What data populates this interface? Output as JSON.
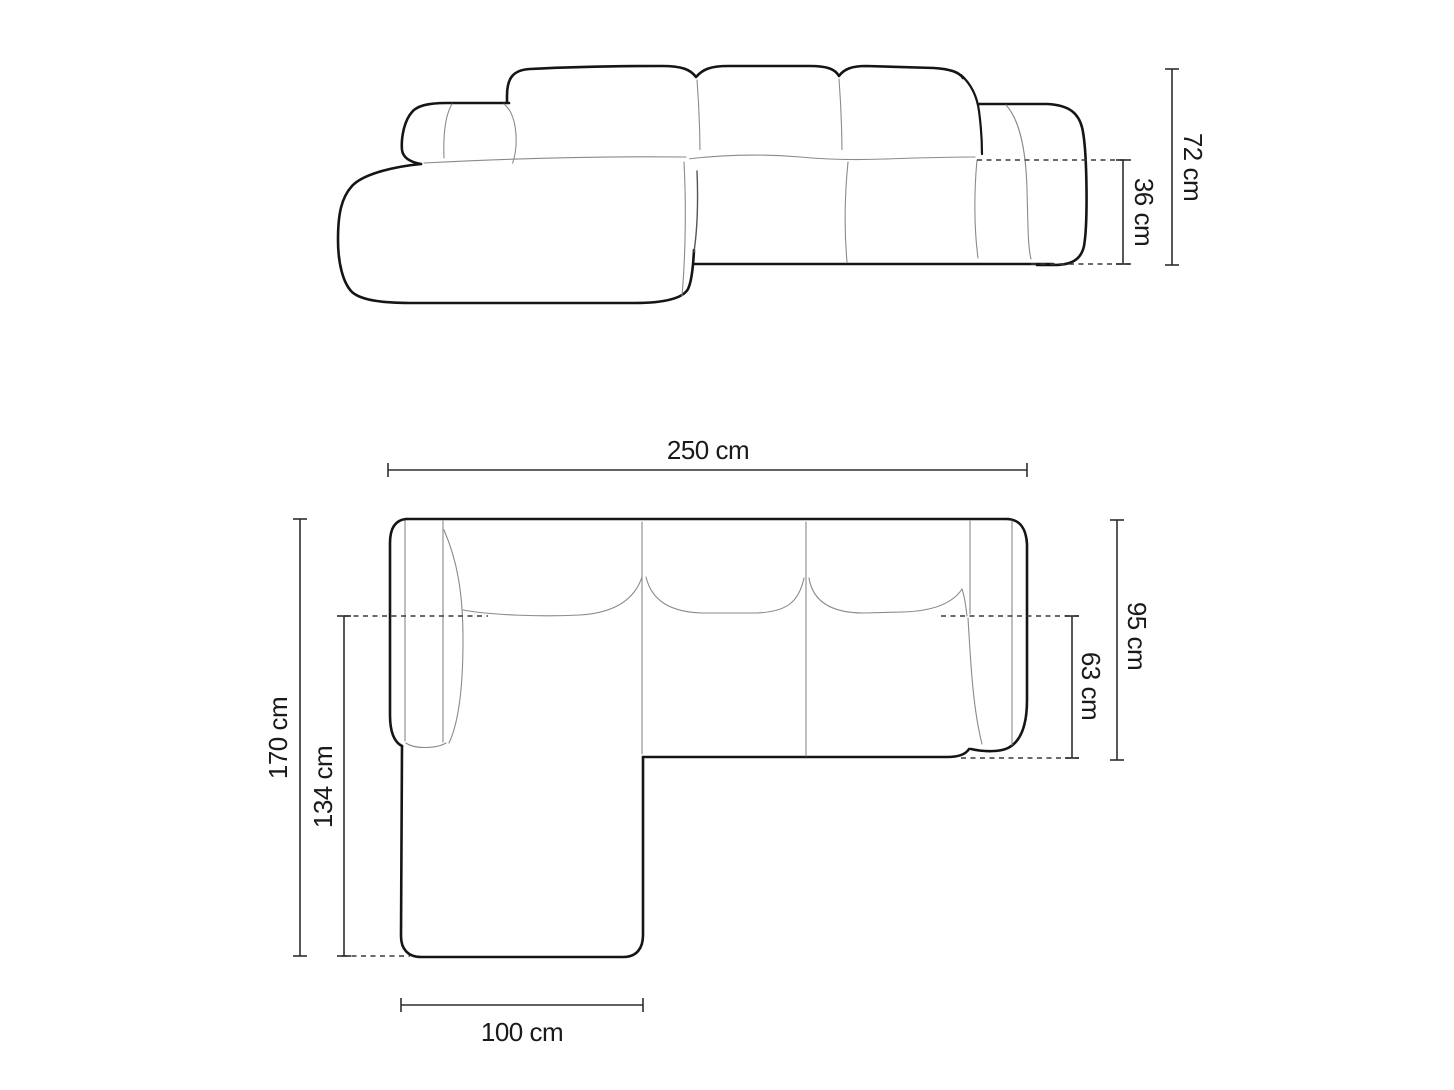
{
  "diagram": {
    "type": "sofa-dimension-drawing",
    "subject": "left-corner sofa with chaise",
    "views": {
      "front": {
        "name": "front elevation",
        "dims": {
          "total_height": "72 cm",
          "seat_height": "36 cm"
        }
      },
      "top": {
        "name": "top plan",
        "dims": {
          "total_width": "250 cm",
          "total_depth": "170 cm",
          "chaise_inner_length": "134 cm",
          "body_depth": "95 cm",
          "seat_depth": "63 cm",
          "chaise_width": "100 cm"
        }
      }
    },
    "colors": {
      "background": "#ffffff",
      "outline": "#151515",
      "seam": "#8a8a8a",
      "dimension_line": "#2e2e2e",
      "label_text": "#1a1a1a"
    }
  }
}
